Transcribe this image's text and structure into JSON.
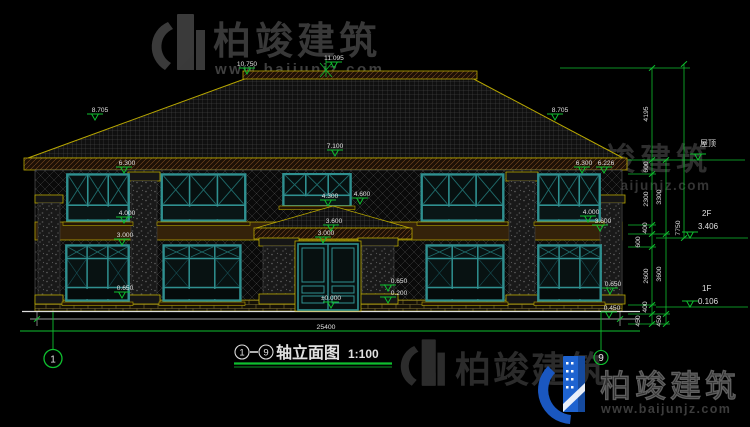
{
  "watermark": {
    "brand": "柏竣建筑",
    "url": "www.baijunjz.com"
  },
  "title": {
    "axis_from": "1",
    "axis_to": "9",
    "name": "轴立面图",
    "scale": "1:100"
  },
  "axis_bubbles": {
    "left": "1",
    "right": "9"
  },
  "levels": {
    "roof": "屋顶",
    "f2_label": "2F",
    "f2_value": "3.406",
    "f1_label": "1F",
    "f1_value": "0.106"
  },
  "dimensions": {
    "bottom_total": "25400",
    "right_total": "7750",
    "right_inner": [
      "4195",
      "600",
      "2300",
      "400",
      "600",
      "2600",
      "400",
      "450"
    ],
    "right_outer": [
      "3300",
      "3600",
      "450"
    ]
  },
  "markers": [
    "10.750",
    "11.095",
    "8.705",
    "8.705",
    "7.100",
    "6.300",
    "6.300",
    "6.226",
    "4.300",
    "4.600",
    "4.000",
    "3.000",
    "4.000",
    "3.600",
    "3.600",
    "3.000",
    "±0.000",
    "0.650",
    "0.200",
    "0.650",
    "0.650",
    "0.450"
  ],
  "colors": {
    "background": "#000000",
    "cad_green": "#0fbf2f",
    "trim_yellow": "#b9a800",
    "window_teal": "#2f9090",
    "dim_text": "#e0e0e0",
    "watermark_gray": "#343434",
    "logo_blue": "#1e63d0"
  }
}
